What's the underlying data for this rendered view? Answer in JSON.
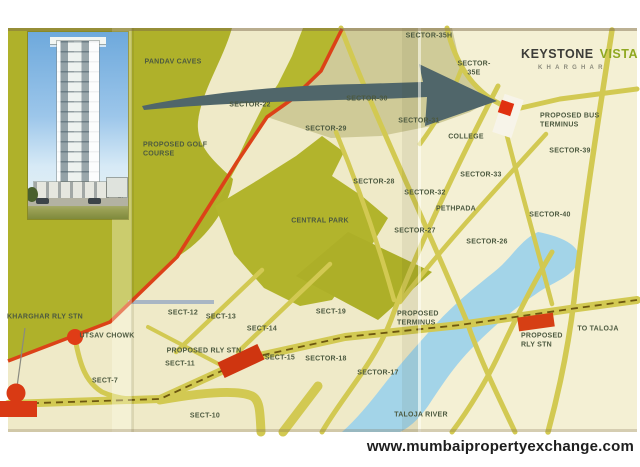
{
  "branding": {
    "brand": "KEYSTONE",
    "divider": "|",
    "product": "VISTA",
    "location": "KHARGHAR"
  },
  "footer": {
    "website": "www.mumbaipropertyexchange.com"
  },
  "map": {
    "colors": {
      "paper": "#efeac8",
      "hills": "#b0b22a",
      "roads": "#d2c952",
      "highway_red": "#dc4218",
      "river": "#a3d4e8",
      "arrow": "#50666a",
      "site_red": "#e03010",
      "rail_dash": "#6d5710",
      "khaki_zone": "#cbc691",
      "label_text": "#4d5a40"
    },
    "labels": [
      {
        "text": "PANDAV CAVES",
        "x": 173,
        "y": 63
      },
      {
        "text": "SECTOR-35H",
        "x": 429,
        "y": 37
      },
      {
        "text": "SECTOR-\n35E",
        "x": 474,
        "y": 69
      },
      {
        "text": "SECTOR-22",
        "x": 250,
        "y": 106
      },
      {
        "text": "SECTOR-30",
        "x": 367,
        "y": 100
      },
      {
        "text": "SECTOR-29",
        "x": 326,
        "y": 130
      },
      {
        "text": "SECTOR-31",
        "x": 419,
        "y": 122
      },
      {
        "text": "COLLEGE",
        "x": 466,
        "y": 138
      },
      {
        "text": "PROPOSED BUS\nTERMINUS",
        "x": 540,
        "y": 121,
        "align": "left"
      },
      {
        "text": "SECTOR-39",
        "x": 570,
        "y": 152
      },
      {
        "text": "PROPOSED GOLF\nCOURSE",
        "x": 143,
        "y": 150,
        "align": "left"
      },
      {
        "text": "SECTOR-28",
        "x": 374,
        "y": 183
      },
      {
        "text": "SECTOR-32",
        "x": 425,
        "y": 194
      },
      {
        "text": "SECTOR-33",
        "x": 481,
        "y": 176
      },
      {
        "text": "PETHPADA",
        "x": 456,
        "y": 210
      },
      {
        "text": "SECTOR-40",
        "x": 550,
        "y": 216
      },
      {
        "text": "SECTOR-27",
        "x": 415,
        "y": 232
      },
      {
        "text": "SECTOR-26",
        "x": 487,
        "y": 243
      },
      {
        "text": "CENTRAL PARK",
        "x": 320,
        "y": 222
      },
      {
        "text": "KHARGHAR RLY STN",
        "x": 7,
        "y": 318,
        "align": "left"
      },
      {
        "text": "UTSAV CHOWK",
        "x": 107,
        "y": 337
      },
      {
        "text": "SECT-12",
        "x": 183,
        "y": 314
      },
      {
        "text": "SECT-13",
        "x": 221,
        "y": 318
      },
      {
        "text": "SECT-14",
        "x": 262,
        "y": 330
      },
      {
        "text": "SECT-19",
        "x": 331,
        "y": 313
      },
      {
        "text": "PROPOSED\nTERMINUS",
        "x": 397,
        "y": 319,
        "align": "left"
      },
      {
        "text": "PROPOSED RLY STN",
        "x": 204,
        "y": 352
      },
      {
        "text": "SECT-11",
        "x": 180,
        "y": 365
      },
      {
        "text": "SECT-15",
        "x": 280,
        "y": 359
      },
      {
        "text": "SECTOR-18",
        "x": 326,
        "y": 360
      },
      {
        "text": "SECT-7",
        "x": 105,
        "y": 382
      },
      {
        "text": "SECTOR-17",
        "x": 378,
        "y": 374
      },
      {
        "text": "SECT-10",
        "x": 205,
        "y": 417
      },
      {
        "text": "TALOJA RIVER",
        "x": 421,
        "y": 416
      },
      {
        "text": "TO TALOJA",
        "x": 598,
        "y": 330
      },
      {
        "text": "PROPOSED\nRLY STN",
        "x": 521,
        "y": 341,
        "align": "left"
      }
    ],
    "markers": [
      {
        "name": "site-parcel",
        "x": 508,
        "y": 116,
        "w": 20,
        "h": 40,
        "rot": 18,
        "color": "#f7f4e9",
        "round": false
      },
      {
        "name": "site-building-marker",
        "x": 506,
        "y": 108,
        "w": 13,
        "h": 13,
        "rot": 18,
        "color": "#e03010",
        "round": false
      },
      {
        "name": "utsav-chowk-dot",
        "x": 75,
        "y": 337,
        "w": 16,
        "h": 16,
        "rot": 0,
        "color": "#e03c16",
        "round": true
      },
      {
        "name": "kharghar-station-dome",
        "x": 16,
        "y": 393,
        "w": 19,
        "h": 19,
        "rot": 0,
        "color": "#d93a14",
        "round": true
      },
      {
        "name": "kharghar-station-base",
        "x": 18,
        "y": 409,
        "w": 38,
        "h": 16,
        "rot": 0,
        "color": "#d93a14",
        "round": false
      },
      {
        "name": "proposed-rly-stn-marker",
        "x": 241,
        "y": 361,
        "w": 44,
        "h": 17,
        "rot": -25,
        "color": "#cf3510",
        "round": false
      },
      {
        "name": "proposed-rly-stn-taloja-marker",
        "x": 536,
        "y": 322,
        "w": 36,
        "h": 14,
        "rot": -8,
        "color": "#d63f14",
        "round": false
      }
    ]
  }
}
